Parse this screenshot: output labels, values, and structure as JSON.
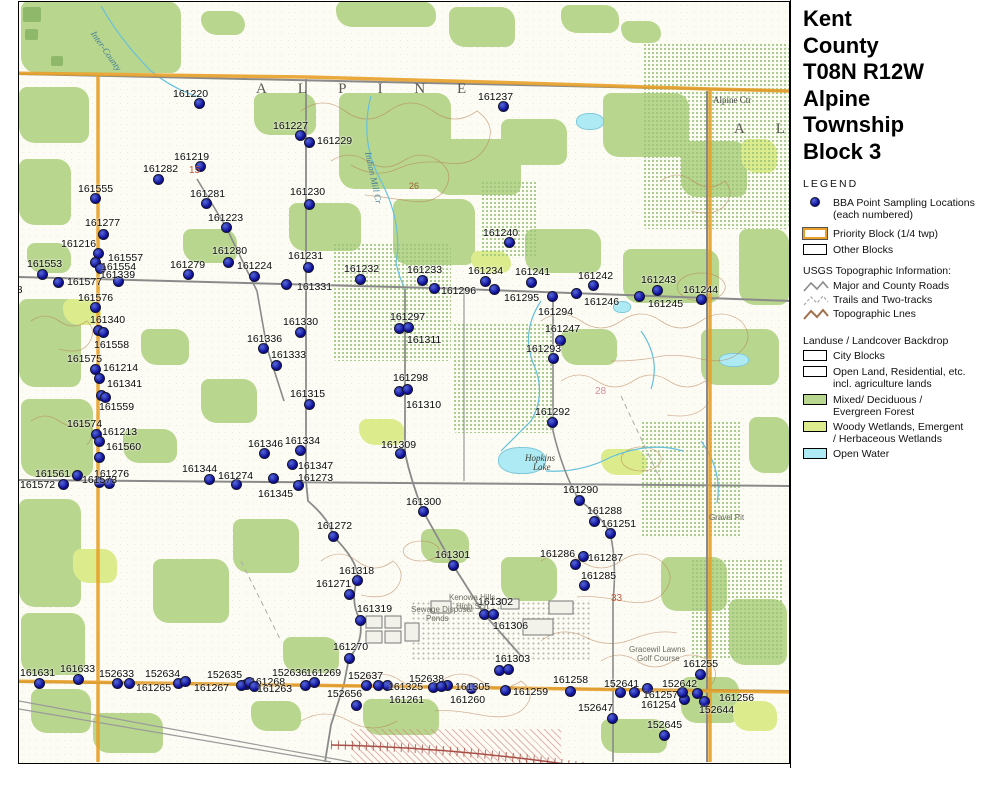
{
  "title_lines": [
    "Kent",
    "County",
    "T08N R12W",
    "Alpine",
    "Township",
    "Block 3"
  ],
  "legend": {
    "heading": "LEGEND",
    "bba_line1": "BBA Point Sampling Locations",
    "bba_line2": "(each numbered)",
    "priority_block": "Priority Block (1/4 twp)",
    "other_blocks": "Other Blocks",
    "usgs_heading": "USGS Topographic Information:",
    "usgs_items": [
      "Major and County Roads",
      "Trails and Two-tracks",
      "Topographic Lnes"
    ],
    "landuse_heading": "Landuse / Landcover Backdrop",
    "city_blocks": "City Blocks",
    "open_land_1": "Open Land, Residential, etc.",
    "open_land_2": "incl. agriculture lands",
    "forest_1": "Mixed/ Deciduous /",
    "forest_2": "Evergreen Forest",
    "wetland_1": "Woody Wetlands, Emergent",
    "wetland_2": "/ Herbaceous Wetlands",
    "open_water": "Open Water"
  },
  "logo": {
    "name": "MICHIGAN",
    "subtitle": "Breeding Bird Atlas",
    "years": "2002 - 2007",
    "numeral": "II"
  },
  "north_label": "N",
  "scalebars": {
    "miles": {
      "ticks": [
        "0",
        "0.1",
        "0.2",
        "0.3",
        "0.4",
        "0.5"
      ],
      "unit": "Miles"
    },
    "km": {
      "ticks": [
        "0",
        "0.2",
        "0.4",
        "0.6"
      ],
      "unit": "Kilometers"
    }
  },
  "revision": "(rev. 2005 may 18)",
  "colors": {
    "point": "#0d0d96",
    "priority_block": "#e8a028",
    "forest": "#b9d68e",
    "wetland": "#dcec8c",
    "water": "#aeeaf4",
    "road": "#888888",
    "contour": "#a9714a"
  },
  "map": {
    "points": [
      [
        "161220",
        198,
        102,
        172,
        88
      ],
      [
        "161237",
        502,
        105,
        477,
        91
      ],
      [
        "161227",
        299,
        134,
        272,
        120
      ],
      [
        "161229",
        308,
        141,
        316,
        135
      ],
      [
        "161219",
        199,
        165,
        173,
        151
      ],
      [
        "161282",
        157,
        178,
        142,
        163
      ],
      [
        "161555",
        94,
        197,
        77,
        183
      ],
      [
        "161281",
        205,
        202,
        189,
        188
      ],
      [
        "161223",
        225,
        226,
        207,
        212
      ],
      [
        "161277",
        102,
        233,
        84,
        217
      ],
      [
        "161230",
        308,
        203,
        289,
        186
      ],
      [
        "161216",
        97,
        252,
        60,
        238
      ],
      [
        "161240",
        508,
        241,
        482,
        227
      ],
      [
        "161231",
        307,
        266,
        287,
        250
      ],
      [
        "161557",
        94,
        261,
        107,
        252
      ],
      [
        "161554",
        99,
        267,
        100,
        261
      ],
      [
        "161339",
        117,
        280,
        99,
        269
      ],
      [
        "161553",
        41,
        273,
        26,
        258
      ],
      [
        "161279",
        187,
        273,
        169,
        259
      ],
      [
        "161280",
        227,
        261,
        211,
        245
      ],
      [
        "161224",
        253,
        275,
        236,
        260
      ],
      [
        "161577",
        57,
        281,
        66,
        276
      ],
      [
        "161576",
        94,
        306,
        77,
        292
      ],
      [
        "161331",
        285,
        283,
        296,
        281
      ],
      [
        "161232",
        359,
        278,
        343,
        263
      ],
      [
        "161233",
        421,
        279,
        406,
        264
      ],
      [
        "161296",
        433,
        287,
        440,
        285
      ],
      [
        "161234",
        484,
        280,
        467,
        265
      ],
      [
        "161295",
        493,
        288,
        503,
        292
      ],
      [
        "161241",
        530,
        281,
        514,
        266
      ],
      [
        "161242",
        592,
        284,
        577,
        270
      ],
      [
        "161246",
        575,
        292,
        583,
        296
      ],
      [
        "161243",
        656,
        289,
        640,
        274
      ],
      [
        "161245",
        638,
        295,
        647,
        298
      ],
      [
        "161244",
        700,
        298,
        682,
        284
      ],
      [
        "161294",
        551,
        295,
        537,
        306
      ],
      [
        "161247",
        559,
        339,
        544,
        323
      ],
      [
        "161293",
        552,
        357,
        525,
        343
      ],
      [
        "161330",
        299,
        331,
        282,
        316
      ],
      [
        "161297",
        398,
        327,
        389,
        311
      ],
      [
        "161311",
        407,
        326,
        406,
        334
      ],
      [
        "161336",
        262,
        347,
        246,
        333
      ],
      [
        "161333",
        275,
        364,
        270,
        349
      ],
      [
        "161340",
        97,
        329,
        89,
        314
      ],
      [
        "161558",
        102,
        331,
        93,
        339
      ],
      [
        "161575",
        94,
        368,
        66,
        353
      ],
      [
        "161214",
        98,
        377,
        102,
        362
      ],
      [
        "161341",
        100,
        394,
        106,
        378
      ],
      [
        "161559",
        104,
        396,
        98,
        401
      ],
      [
        "161298",
        398,
        390,
        392,
        372
      ],
      [
        "161310",
        406,
        388,
        405,
        399
      ],
      [
        "161315",
        308,
        403,
        289,
        388
      ],
      [
        "161574",
        95,
        433,
        66,
        418
      ],
      [
        "161213",
        98,
        440,
        101,
        426
      ],
      [
        "161560",
        98,
        456,
        105,
        441
      ],
      [
        "161346",
        263,
        452,
        247,
        438
      ],
      [
        "161334",
        299,
        449,
        284,
        435
      ],
      [
        "161309",
        399,
        452,
        380,
        439
      ],
      [
        "161344",
        208,
        478,
        181,
        463
      ],
      [
        "161274",
        235,
        483,
        217,
        470
      ],
      [
        "161561",
        76,
        474,
        34,
        468
      ],
      [
        "161572",
        62,
        483,
        19,
        479
      ],
      [
        "161276",
        108,
        482,
        93,
        468
      ],
      [
        "161573",
        98,
        481,
        81,
        474
      ],
      [
        "161347",
        291,
        463,
        297,
        460
      ],
      [
        "161273",
        272,
        477,
        297,
        472
      ],
      [
        "161345",
        297,
        484,
        257,
        488
      ],
      [
        "161300",
        422,
        510,
        405,
        496
      ],
      [
        "161292",
        551,
        421,
        534,
        406
      ],
      [
        "161290",
        578,
        499,
        562,
        484
      ],
      [
        "161288",
        593,
        520,
        586,
        505
      ],
      [
        "161251",
        609,
        532,
        600,
        518
      ],
      [
        "161272",
        332,
        535,
        316,
        520
      ],
      [
        "161301",
        452,
        564,
        434,
        549
      ],
      [
        "161286",
        574,
        563,
        539,
        548
      ],
      [
        "161287",
        582,
        555,
        587,
        552
      ],
      [
        "161285",
        583,
        584,
        580,
        570
      ],
      [
        "161318",
        356,
        579,
        338,
        565
      ],
      [
        "161271",
        348,
        593,
        315,
        578
      ],
      [
        "161319",
        359,
        619,
        356,
        603
      ],
      [
        "161302",
        483,
        613,
        477,
        596
      ],
      [
        "161306",
        492,
        613,
        492,
        620
      ],
      [
        "161270",
        348,
        657,
        332,
        641
      ],
      [
        "161303",
        498,
        669,
        494,
        653
      ],
      [
        "161631",
        38,
        682,
        19,
        667
      ],
      [
        "161633",
        77,
        678,
        59,
        663
      ],
      [
        "152633",
        116,
        682,
        98,
        668
      ],
      [
        "161265",
        128,
        682,
        135,
        682
      ],
      [
        "152634",
        177,
        682,
        144,
        668
      ],
      [
        "152635",
        245,
        683,
        206,
        669
      ],
      [
        "161267",
        240,
        684,
        193,
        682
      ],
      [
        "161268",
        248,
        681,
        249,
        676
      ],
      [
        "161263",
        253,
        685,
        256,
        683
      ],
      [
        "152636",
        304,
        684,
        271,
        667
      ],
      [
        "161269",
        313,
        681,
        305,
        667
      ],
      [
        "152637",
        365,
        684,
        347,
        670
      ],
      [
        "152656",
        355,
        704,
        326,
        688
      ],
      [
        "161325",
        386,
        684,
        387,
        681
      ],
      [
        "161261",
        377,
        684,
        388,
        694
      ],
      [
        "152638",
        432,
        686,
        408,
        673
      ],
      [
        "161260",
        446,
        684,
        449,
        694
      ],
      [
        "161305",
        470,
        687,
        454,
        681
      ],
      [
        "161259",
        504,
        689,
        512,
        686
      ],
      [
        "161258",
        569,
        690,
        552,
        674
      ],
      [
        "152641",
        619,
        691,
        603,
        678
      ],
      [
        "152647",
        611,
        717,
        577,
        702
      ],
      [
        "161257",
        646,
        687,
        642,
        689
      ],
      [
        "161254",
        683,
        698,
        640,
        699
      ],
      [
        "152642",
        681,
        691,
        661,
        678
      ],
      [
        "161255",
        699,
        673,
        682,
        658
      ],
      [
        "161256",
        696,
        692,
        718,
        692
      ],
      [
        "152644",
        703,
        700,
        698,
        704
      ],
      [
        "152645",
        663,
        734,
        646,
        719
      ]
    ],
    "extra_dots": [
      [
        507,
        668
      ],
      [
        633,
        691
      ],
      [
        184,
        680
      ],
      [
        440,
        685
      ]
    ],
    "place_labels": [
      {
        "text": "A L P I N E",
        "x": 255,
        "y": 80,
        "cls": "pl-big"
      },
      {
        "text": "A L",
        "x": 733,
        "y": 120,
        "cls": "pl-big"
      },
      {
        "text": "Alpine Ctr",
        "x": 712,
        "y": 94,
        "cls": "pl-town"
      },
      {
        "text": "Hopkins",
        "x": 524,
        "y": 452,
        "cls": "pl-feat"
      },
      {
        "text": "Lake",
        "x": 532,
        "y": 461,
        "cls": "pl-feat"
      },
      {
        "text": "Sewage Disposal",
        "x": 410,
        "y": 604,
        "cls": "pl-gray"
      },
      {
        "text": "Ponds",
        "x": 425,
        "y": 613,
        "cls": "pl-gray"
      },
      {
        "text": "Kenowa Hills",
        "x": 448,
        "y": 592,
        "cls": "pl-gray"
      },
      {
        "text": "High Sch",
        "x": 455,
        "y": 601,
        "cls": "pl-gray"
      },
      {
        "text": "Gracewil Lawns",
        "x": 628,
        "y": 644,
        "cls": "pl-gray"
      },
      {
        "text": "Golf Course",
        "x": 636,
        "y": 653,
        "cls": "pl-gray"
      },
      {
        "text": "Gravel Pit",
        "x": 708,
        "y": 512,
        "cls": "pl-gray"
      },
      {
        "text": "Indian Mill Cr",
        "x": 372,
        "y": 150,
        "cls": "pl-stream",
        "rot": 78
      },
      {
        "text": "Inter-County",
        "x": 96,
        "y": 28,
        "cls": "pl-stream",
        "rot": 55
      },
      {
        "text": "578",
        "x": 4,
        "y": 283,
        "cls": "pl-point"
      },
      {
        "text": "26",
        "x": 408,
        "y": 180,
        "cls": "pl-brown"
      },
      {
        "text": "28",
        "x": 594,
        "y": 385,
        "cls": "pl-pink"
      },
      {
        "text": "33",
        "x": 610,
        "y": 592,
        "cls": "pl-red"
      },
      {
        "text": "15",
        "x": 188,
        "y": 164,
        "cls": "pl-red"
      }
    ]
  }
}
